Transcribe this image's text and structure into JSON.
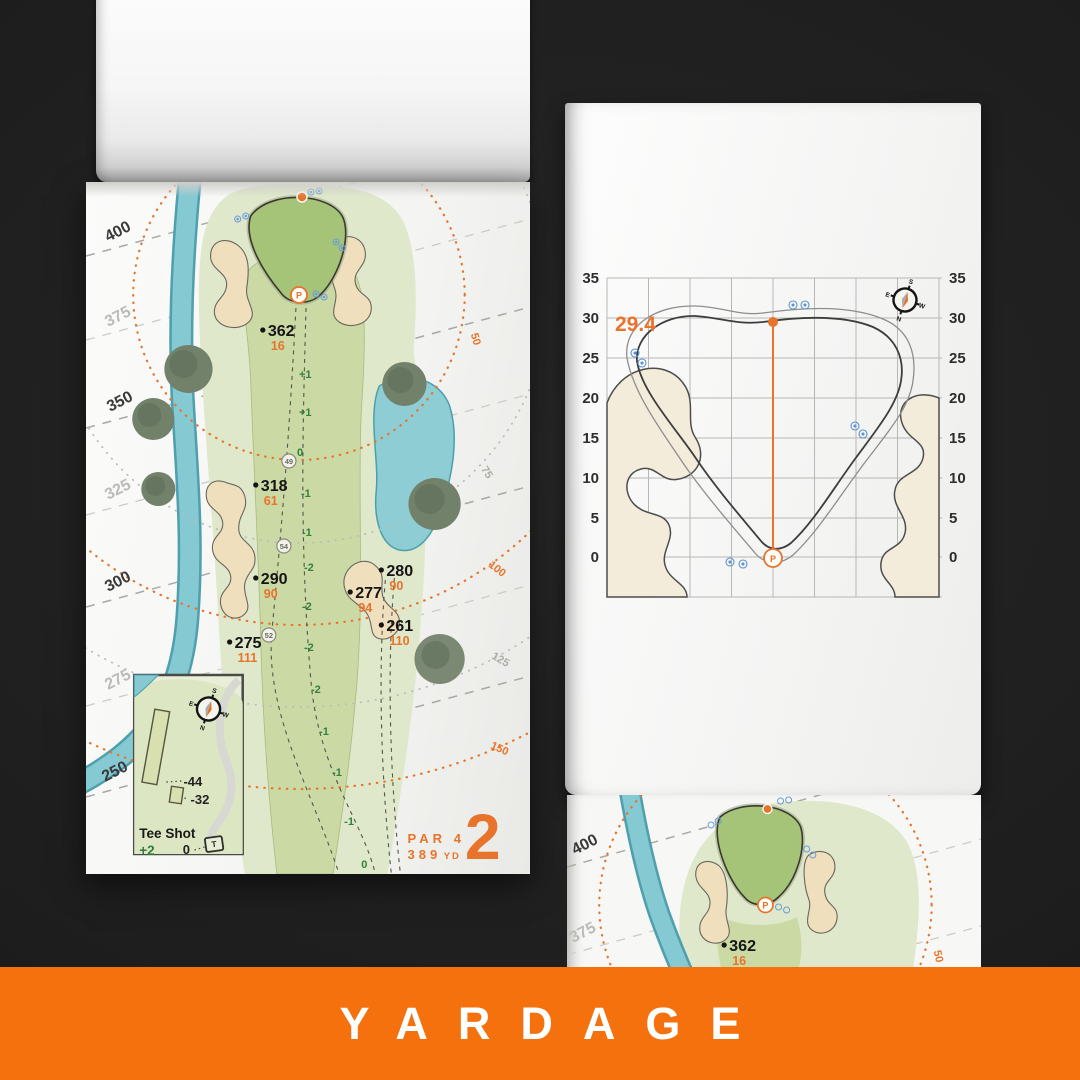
{
  "banner": {
    "label": "YARDAGE",
    "bg": "#f4710e"
  },
  "hole": {
    "number": "2",
    "par": "PAR 4",
    "yards": "389",
    "unit": "YD"
  },
  "compass": {
    "n": "N",
    "s": "S",
    "e": "E",
    "w": "W"
  },
  "left_map": {
    "edge_labels": [
      {
        "text": "400"
      },
      {
        "text": "375"
      },
      {
        "text": "350"
      },
      {
        "text": "325"
      },
      {
        "text": "300"
      },
      {
        "text": "275"
      },
      {
        "text": "250"
      }
    ],
    "ring_labels": [
      {
        "text": "50"
      },
      {
        "text": "75"
      },
      {
        "text": "100"
      },
      {
        "text": "125"
      },
      {
        "text": "150"
      }
    ],
    "points": [
      {
        "carry": "362",
        "front": "16"
      },
      {
        "carry": "318",
        "front": "61"
      },
      {
        "carry": "290",
        "front": "90"
      },
      {
        "carry": "280",
        "front": "90"
      },
      {
        "carry": "277",
        "front": "94"
      },
      {
        "carry": "261",
        "front": "110"
      },
      {
        "carry": "275",
        "front": "111"
      }
    ],
    "sprinkler_numbers": [
      "49",
      "54",
      "52"
    ],
    "elevations": [
      "+1",
      "+1",
      "0",
      "-1",
      "-1",
      "-2",
      "-2",
      "-2",
      "-2",
      "-1",
      "-1",
      "-1",
      "0"
    ],
    "pin": "P"
  },
  "tee_inset": {
    "title": "Tee Shot",
    "elevation": "+2",
    "zero": "0",
    "offset_long": "-44",
    "offset_short": "-32",
    "marker": "T"
  },
  "green_chart": {
    "pin_depth": "29.4",
    "ticks": [
      "35",
      "30",
      "25",
      "20",
      "15",
      "10",
      "5",
      "0"
    ],
    "pin": "P"
  },
  "bottom_map": {
    "edge_labels": [
      {
        "text": "400"
      },
      {
        "text": "375"
      }
    ],
    "point": {
      "carry": "362",
      "front": "16"
    },
    "ring_label": "50",
    "pin": "P"
  },
  "colors": {
    "accent_orange": "#e8732a",
    "banner_orange": "#f4710e",
    "fairway_green": "#cbd9a4",
    "rough_green": "#dfe8ca",
    "putting_green": "#a5c478",
    "water_teal": "#85c9d2",
    "bunker_sand": "#efdfbd"
  }
}
